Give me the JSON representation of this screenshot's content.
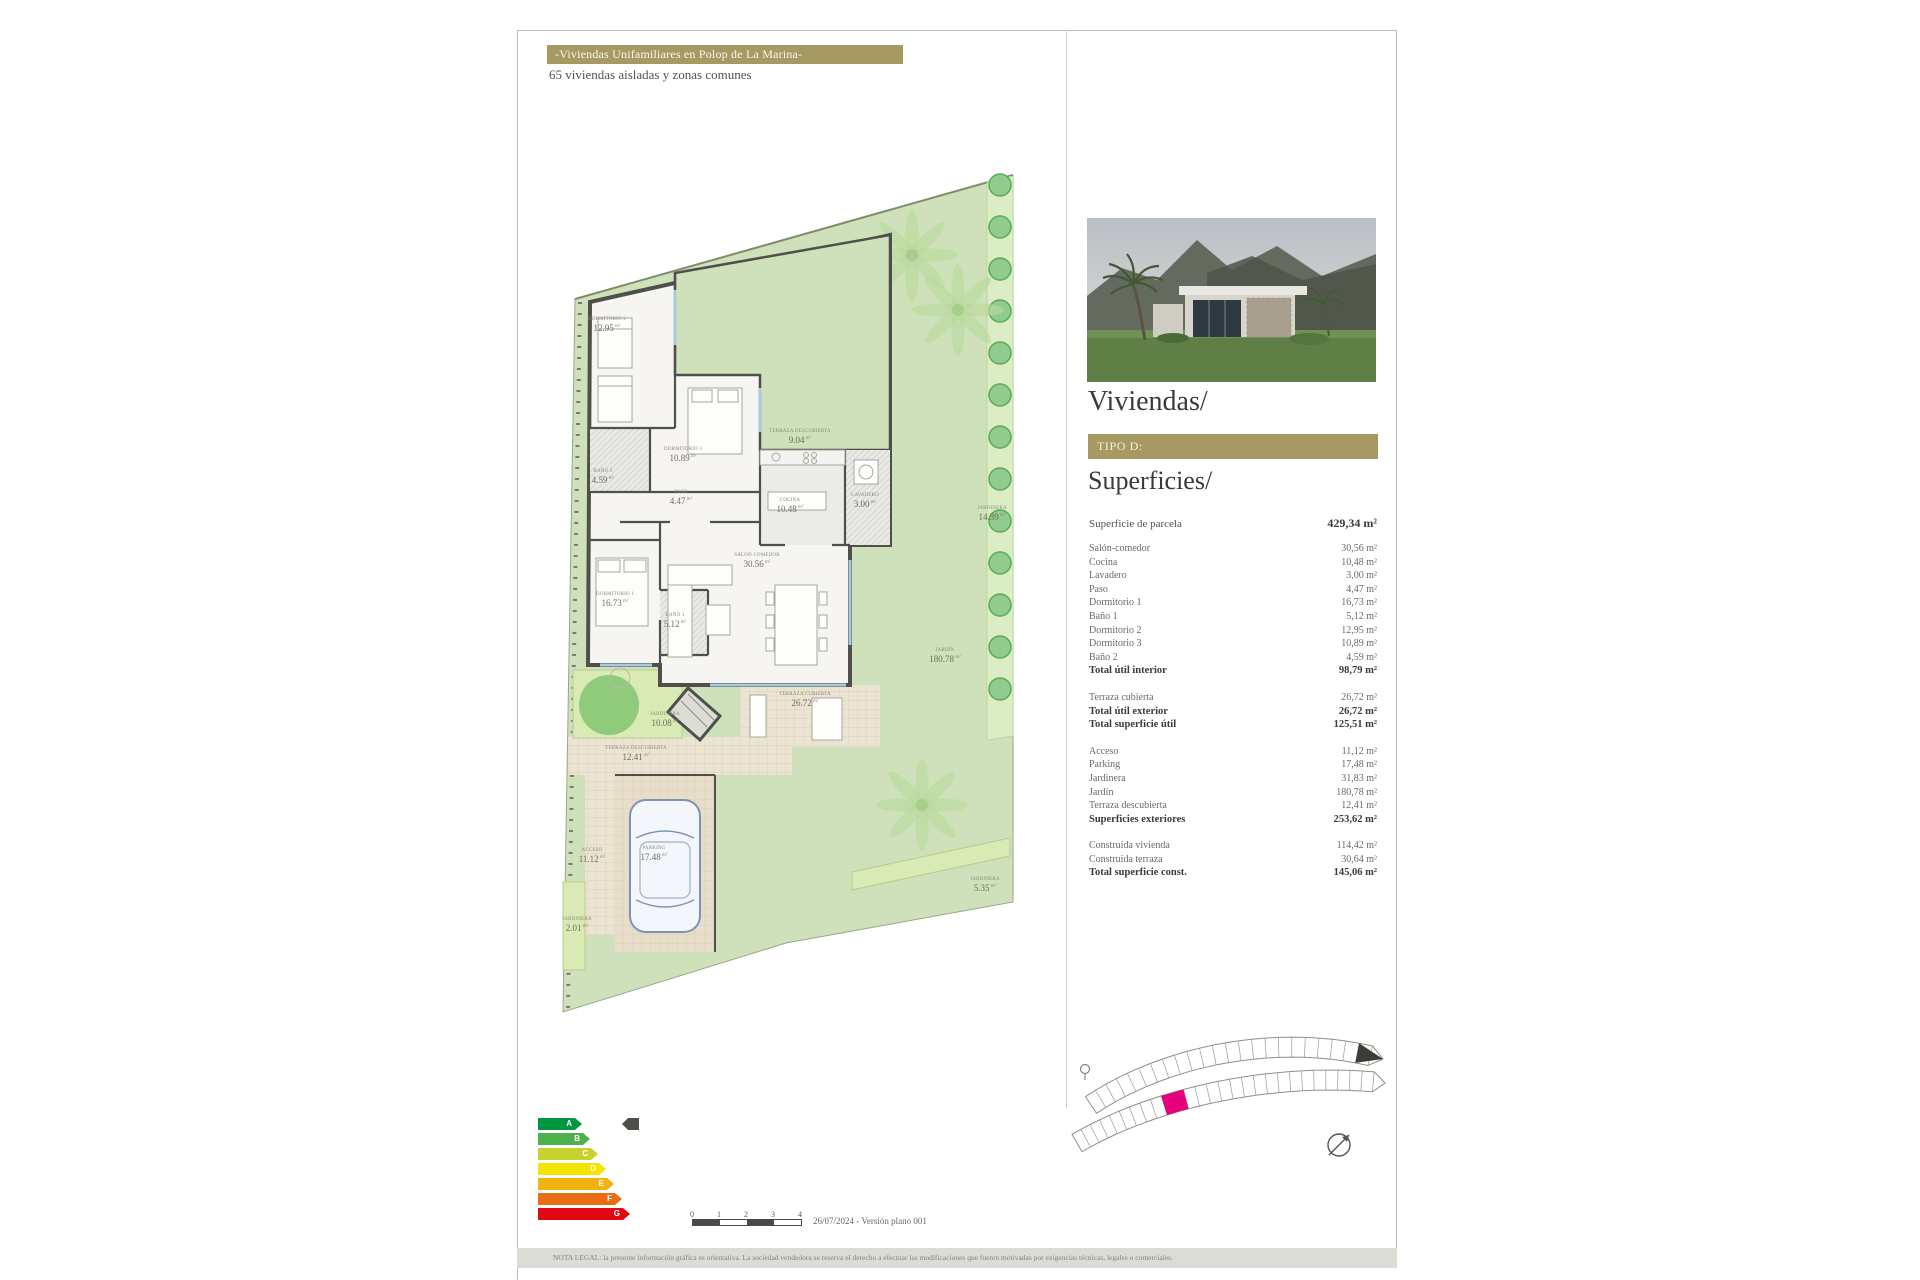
{
  "theme": {
    "gold": "#a69a62",
    "highlight_pink": "#e6007e",
    "wall_gray": "#4f4f4b",
    "garden_green": "#cfe1ba",
    "tile_beige": "#ece4d2"
  },
  "header": {
    "title": "-Viviendas Unifamiliares en Polop de La Marina-",
    "subtitle": "65 viviendas aisladas y zonas comunes"
  },
  "panel": {
    "heading": "Viviendas/",
    "type_label": "TIPO D:",
    "surfaces_heading": "Superficies/",
    "parcel_row": {
      "label": "Superficie de parcela",
      "value": "429,34 m²"
    },
    "groups": [
      {
        "rows": [
          {
            "label": "Salón-comedor",
            "value": "30,56 m²"
          },
          {
            "label": "Cocina",
            "value": "10,48 m²"
          },
          {
            "label": "Lavadero",
            "value": "3,00 m²"
          },
          {
            "label": "Paso",
            "value": "4,47 m²"
          },
          {
            "label": "Dormitorio 1",
            "value": "16,73 m²"
          },
          {
            "label": "Baño 1",
            "value": "5,12 m²"
          },
          {
            "label": "Dormitorio 2",
            "value": "12,95 m²"
          },
          {
            "label": "Dormitorio 3",
            "value": "10,89 m²"
          },
          {
            "label": "Baño 2",
            "value": "4,59 m²"
          },
          {
            "label": "Total útil interior",
            "value": "98,79 m²",
            "total": true
          }
        ]
      },
      {
        "rows": [
          {
            "label": "Terraza cubierta",
            "value": "26,72 m²"
          },
          {
            "label": "Total útil exterior",
            "value": "26,72 m²",
            "total": true
          },
          {
            "label": "Total superficie útil",
            "value": "125,51 m²",
            "total": true
          }
        ]
      },
      {
        "rows": [
          {
            "label": "Acceso",
            "value": "11,12 m²"
          },
          {
            "label": "Parking",
            "value": "17,48 m²"
          },
          {
            "label": "Jardinera",
            "value": "31,83 m²"
          },
          {
            "label": "Jardín",
            "value": "180,78 m²"
          },
          {
            "label": "Terraza descubierta",
            "value": "12,41 m²"
          },
          {
            "label": "Superficies exteriores",
            "value": "253,62 m²",
            "total": true
          }
        ]
      },
      {
        "rows": [
          {
            "label": "Construida vivienda",
            "value": "114,42 m²"
          },
          {
            "label": "Construida terraza",
            "value": "30,64 m²"
          },
          {
            "label": "Total superficie const.",
            "value": "145,06 m²",
            "total": true
          }
        ]
      }
    ]
  },
  "plan": {
    "rooms": [
      {
        "id": "dormitorio-2",
        "name": "DORMITORIO 2",
        "area": "12.95",
        "unit": "m²"
      },
      {
        "id": "terraza-descubierta-9",
        "name": "TERRAZA DESCUBIERTA",
        "area": "9.04",
        "unit": "m²"
      },
      {
        "id": "dormitorio-3",
        "name": "DORMITORIO 3",
        "area": "10.89",
        "unit": "m²"
      },
      {
        "id": "bano-2",
        "name": "BAÑO 2",
        "area": "4.59",
        "unit": "m²"
      },
      {
        "id": "paso",
        "name": "PASO",
        "area": "4.47",
        "unit": "m²"
      },
      {
        "id": "cocina",
        "name": "COCINA",
        "area": "10.48",
        "unit": "m²"
      },
      {
        "id": "lavadero",
        "name": "LAVADERO",
        "area": "3.00",
        "unit": "m²"
      },
      {
        "id": "salon-comedor",
        "name": "SALÓN COMEDOR",
        "area": "30.56",
        "unit": "m²"
      },
      {
        "id": "dormitorio-1",
        "name": "DORMITORIO 1",
        "area": "16.73",
        "unit": "m²"
      },
      {
        "id": "bano-1",
        "name": "BAÑO 1",
        "area": "5.12",
        "unit": "m²"
      },
      {
        "id": "jardinera-este",
        "name": "JARDINERA",
        "area": "14.39",
        "unit": "m²"
      },
      {
        "id": "jardin",
        "name": "JARDÍN",
        "area": "180.78",
        "unit": "m²"
      },
      {
        "id": "terraza-cubierta",
        "name": "TERRAZA CUBIERTA",
        "area": "26.72",
        "unit": "m²"
      },
      {
        "id": "jardinera-central",
        "name": "JARDINERA",
        "area": "10.08",
        "unit": "m²"
      },
      {
        "id": "terraza-descubierta-12",
        "name": "TERRAZA DESCUBIERTA",
        "area": "12.41",
        "unit": "m²"
      },
      {
        "id": "acceso",
        "name": "ACCESO",
        "area": "11.12",
        "unit": "m²"
      },
      {
        "id": "parking",
        "name": "PARKING",
        "area": "17.48",
        "unit": "m²"
      },
      {
        "id": "jardinera-oeste",
        "name": "JARDINERA",
        "area": "2.01",
        "unit": "m²"
      },
      {
        "id": "jardinera-sur",
        "name": "JARDINERA",
        "area": "5.35",
        "unit": "m²"
      }
    ]
  },
  "energy": {
    "ratings": [
      {
        "letter": "A",
        "color": "#009640"
      },
      {
        "letter": "B",
        "color": "#4fb14b"
      },
      {
        "letter": "C",
        "color": "#c8d22f"
      },
      {
        "letter": "D",
        "color": "#f2e500"
      },
      {
        "letter": "E",
        "color": "#f0b310"
      },
      {
        "letter": "F",
        "color": "#e96e13"
      },
      {
        "letter": "G",
        "color": "#e30613"
      }
    ]
  },
  "site_plan": {
    "highlight_color": "#e6007e"
  },
  "footer": {
    "scale_ticks": [
      "0",
      "1",
      "2",
      "3",
      "4"
    ],
    "date_version": "26/07/2024 - Versión plano 001",
    "legal": "NOTA LEGAL: la presente información gráfica es orientativa. La sociedad vendedora se reserva el derecho a efectuar las modificaciones que fueren motivadas por exigencias técnicas, legales o comerciales."
  }
}
